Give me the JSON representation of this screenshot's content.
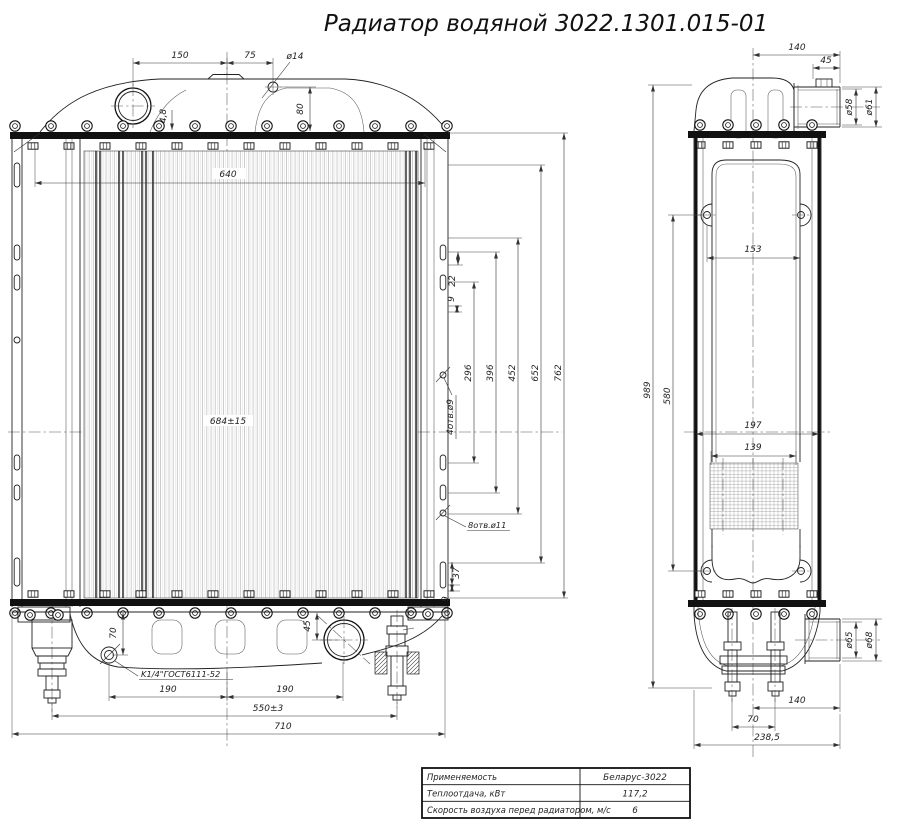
{
  "title": "Радиатор водяной 3022.1301.015-01",
  "front": {
    "d150": "150",
    "d75": "75",
    "dia14": "ø14",
    "d80": "80",
    "d48": "4,8",
    "d640": "640",
    "d684": "684±15",
    "d22": "22",
    "d9_upper": "9",
    "d296": "296",
    "d396": "396",
    "d452": "452",
    "d652": "652",
    "d762": "762",
    "holes4": "4отв.ø9",
    "holes8": "8отв.ø11",
    "d37": "37",
    "d9_lower": "9",
    "d70": "70",
    "d45": "45",
    "drain": "K1/4\"ГОСТ6111-52",
    "d190a": "190",
    "d190b": "190",
    "d550": "550±3",
    "d710": "710"
  },
  "side": {
    "d140_top": "140",
    "d45_top": "45",
    "dia58": "ø58",
    "dia61": "ø61",
    "d153": "153",
    "d989": "989",
    "d580": "580",
    "d197": "197",
    "d139": "139",
    "dia65": "ø65",
    "dia68": "ø68",
    "d140_bottom": "140",
    "d70_bottom": "70",
    "d238": "238,5"
  },
  "table": {
    "rows": [
      {
        "label": "Применяемость",
        "value": "Беларус-3022"
      },
      {
        "label": "Теплоотдача, кВт",
        "value": "117,2"
      },
      {
        "label": "Скорость воздуха перед радиатором, м/с",
        "value": "6"
      }
    ]
  }
}
